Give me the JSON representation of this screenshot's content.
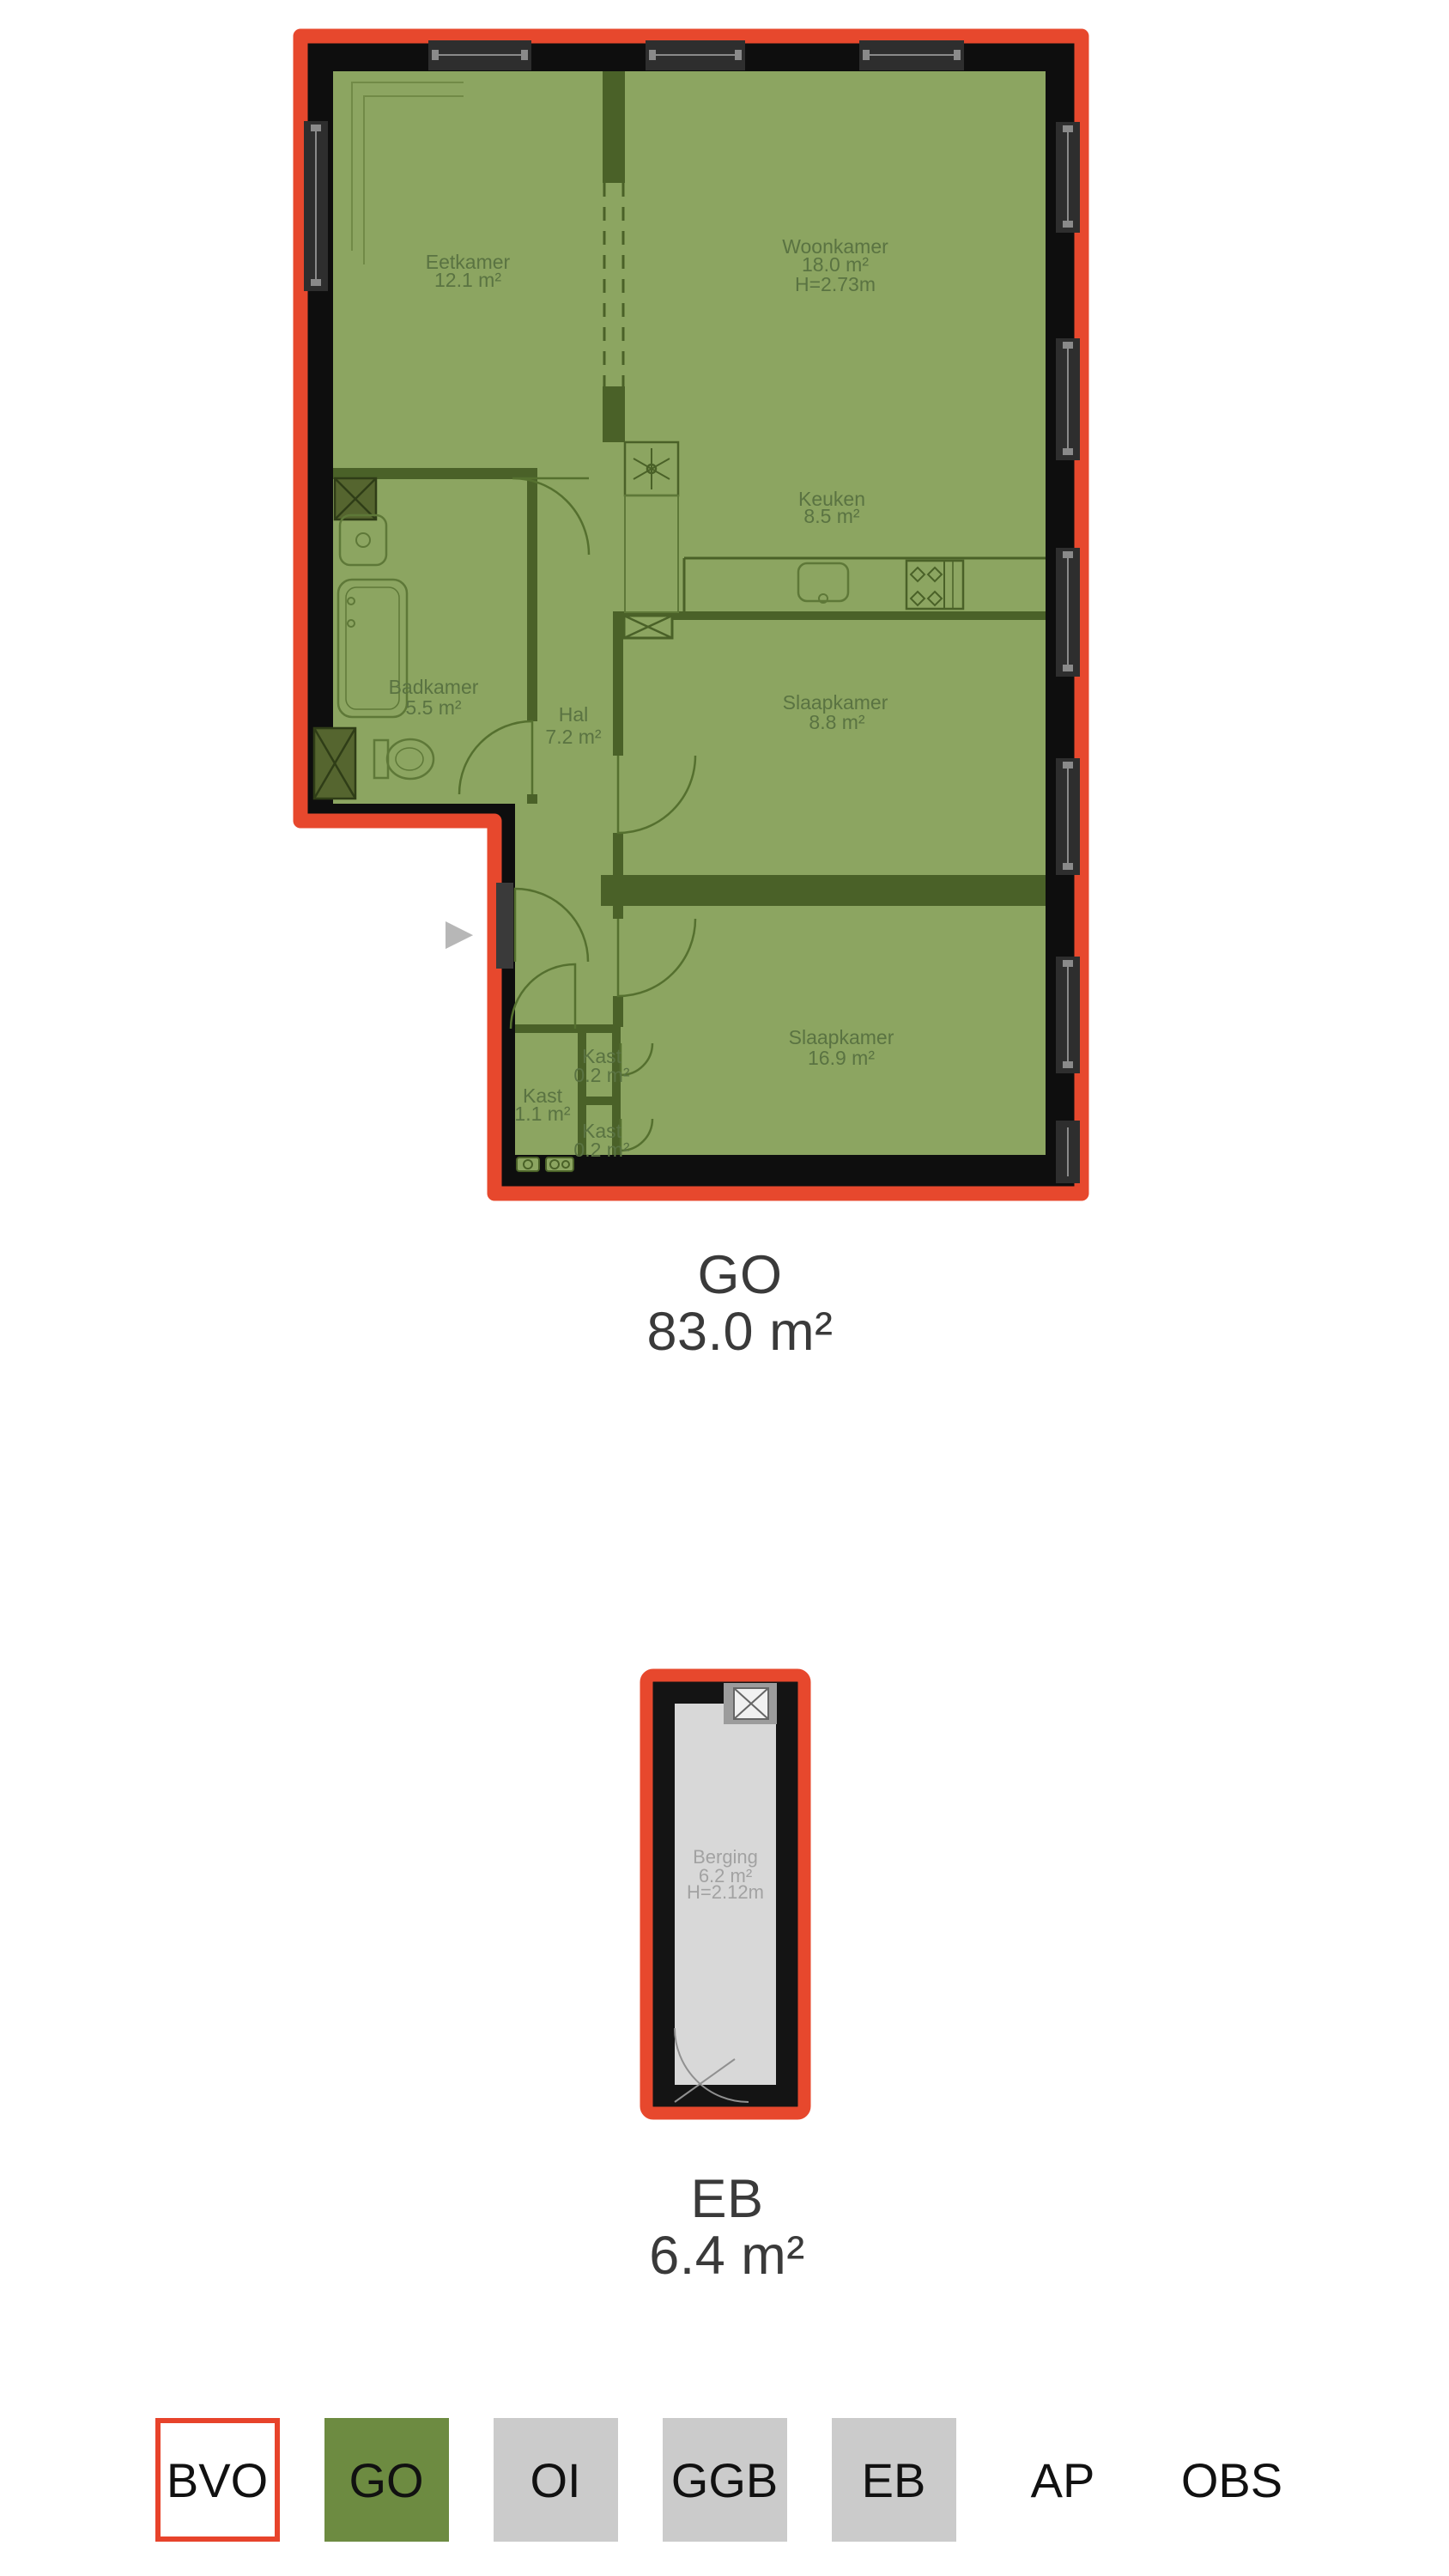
{
  "carousel": {
    "next_icon": "▶"
  },
  "figures": {
    "go": {
      "label": "GO",
      "area_label": "83.0 m²",
      "rooms": [
        {
          "name": "Eetkamer",
          "area": "12.1 m²"
        },
        {
          "name": "Woonkamer",
          "area": "18.0 m²",
          "height": "H=2.73m"
        },
        {
          "name": "Keuken",
          "area": "8.5 m²"
        },
        {
          "name": "Badkamer",
          "area": "5.5 m²"
        },
        {
          "name": "Hal",
          "area": "7.2 m²"
        },
        {
          "name": "Slaapkamer",
          "area": "8.8 m²"
        },
        {
          "name": "Slaapkamer",
          "area": "16.9 m²"
        },
        {
          "name": "Kast",
          "area": "1.1 m²"
        },
        {
          "name": "Kast",
          "area": "0.2 m²"
        },
        {
          "name": "Kast",
          "area": "0.2 m²"
        }
      ]
    },
    "eb": {
      "label": "EB",
      "area_label": "6.4 m²",
      "rooms": [
        {
          "name": "Berging",
          "area": "6.2 m²",
          "height": "H=2.12m"
        }
      ]
    }
  },
  "legend": {
    "items": [
      {
        "label": "BVO",
        "style": "outlined"
      },
      {
        "label": "GO",
        "style": "green"
      },
      {
        "label": "OI",
        "style": "gray"
      },
      {
        "label": "GGB",
        "style": "gray"
      },
      {
        "label": "EB",
        "style": "gray"
      },
      {
        "label": "AP",
        "style": "plain"
      },
      {
        "label": "OBS",
        "style": "plain"
      }
    ]
  },
  "colors": {
    "outline_red": "#E7482D",
    "wall_black": "#0E0E0E",
    "go_green_fill": "#8CA561",
    "partition_green": "#4A6128",
    "room_label_green": "#5A7342",
    "eb_gray_fill": "#D8D8D8",
    "eb_label_gray": "#A2A2A2",
    "caption_gray": "#3A3A3A",
    "legend_green": "#6D8B41",
    "legend_gray": "#CBCBCB",
    "legend_outline_red": "#E7432B",
    "arrow_gray": "#B7B7B7"
  }
}
